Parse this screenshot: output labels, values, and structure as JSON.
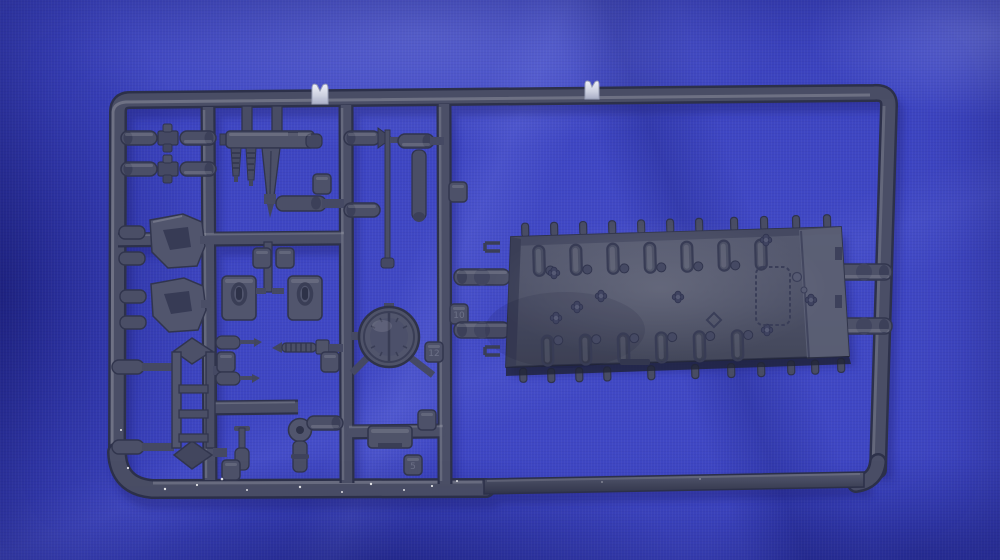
{
  "scene": {
    "type": "photograph",
    "description": "Dark grey injection-moulded plastic model kit sprue (parts tree) lying on a royal blue cloth with soft folds",
    "background": "royal blue fabric"
  },
  "colors": {
    "fabric": "#3d45c2",
    "fabric_highlight": "#6a74e0",
    "fabric_shadow": "#232a96",
    "plastic": "#4b4f67",
    "plastic_dark": "#2d314a",
    "plastic_light": "#6a6e86",
    "hull": "#4e526a",
    "hull_light": "#5d6179",
    "gate_tab": "#dfe2ee",
    "cast_shadow": "#181c72"
  },
  "objects": {
    "frame": "rounded rectangular sprue frame with round runners and a flat bottom strip",
    "runners": "internal runner bars carrying the moulded parts",
    "hull_deck": "large hull deck plate with two rows of suspension bump-stop ridges, clover-shaped bolt heads and a scalloped access panel outline",
    "round_hatch": "circular hatch ring part with centre seam line",
    "ladder": "ladder-shaped frame part with pointed ends",
    "hatch_doors": "two rectangular hatch doors with oval latch detail",
    "mg_mount": "machine-gun mount assembly with two ribbed barrels and tapered blade",
    "clamp_pairs": "paired cylinder parts joined by clamps",
    "brackets": "two angled bracket / mudguard parts",
    "rod": "thin rod part with cone tip and cylinder links",
    "screws": "small screw and pin parts",
    "elbow_pipe": "elbow pipe part with round flange",
    "box_part": "small rectangular box part",
    "connectors": "cylindrical connector runners joining the hull deck to the frame",
    "gate_tabs": "two light grey injection gate tabs on the top rail",
    "number_tabs": "small moulded number tabs on the runners",
    "dust": "white dust specks on the lower runner"
  },
  "tabs": {
    "tab_10": "10",
    "tab_12": "12",
    "tab_5": "5"
  }
}
